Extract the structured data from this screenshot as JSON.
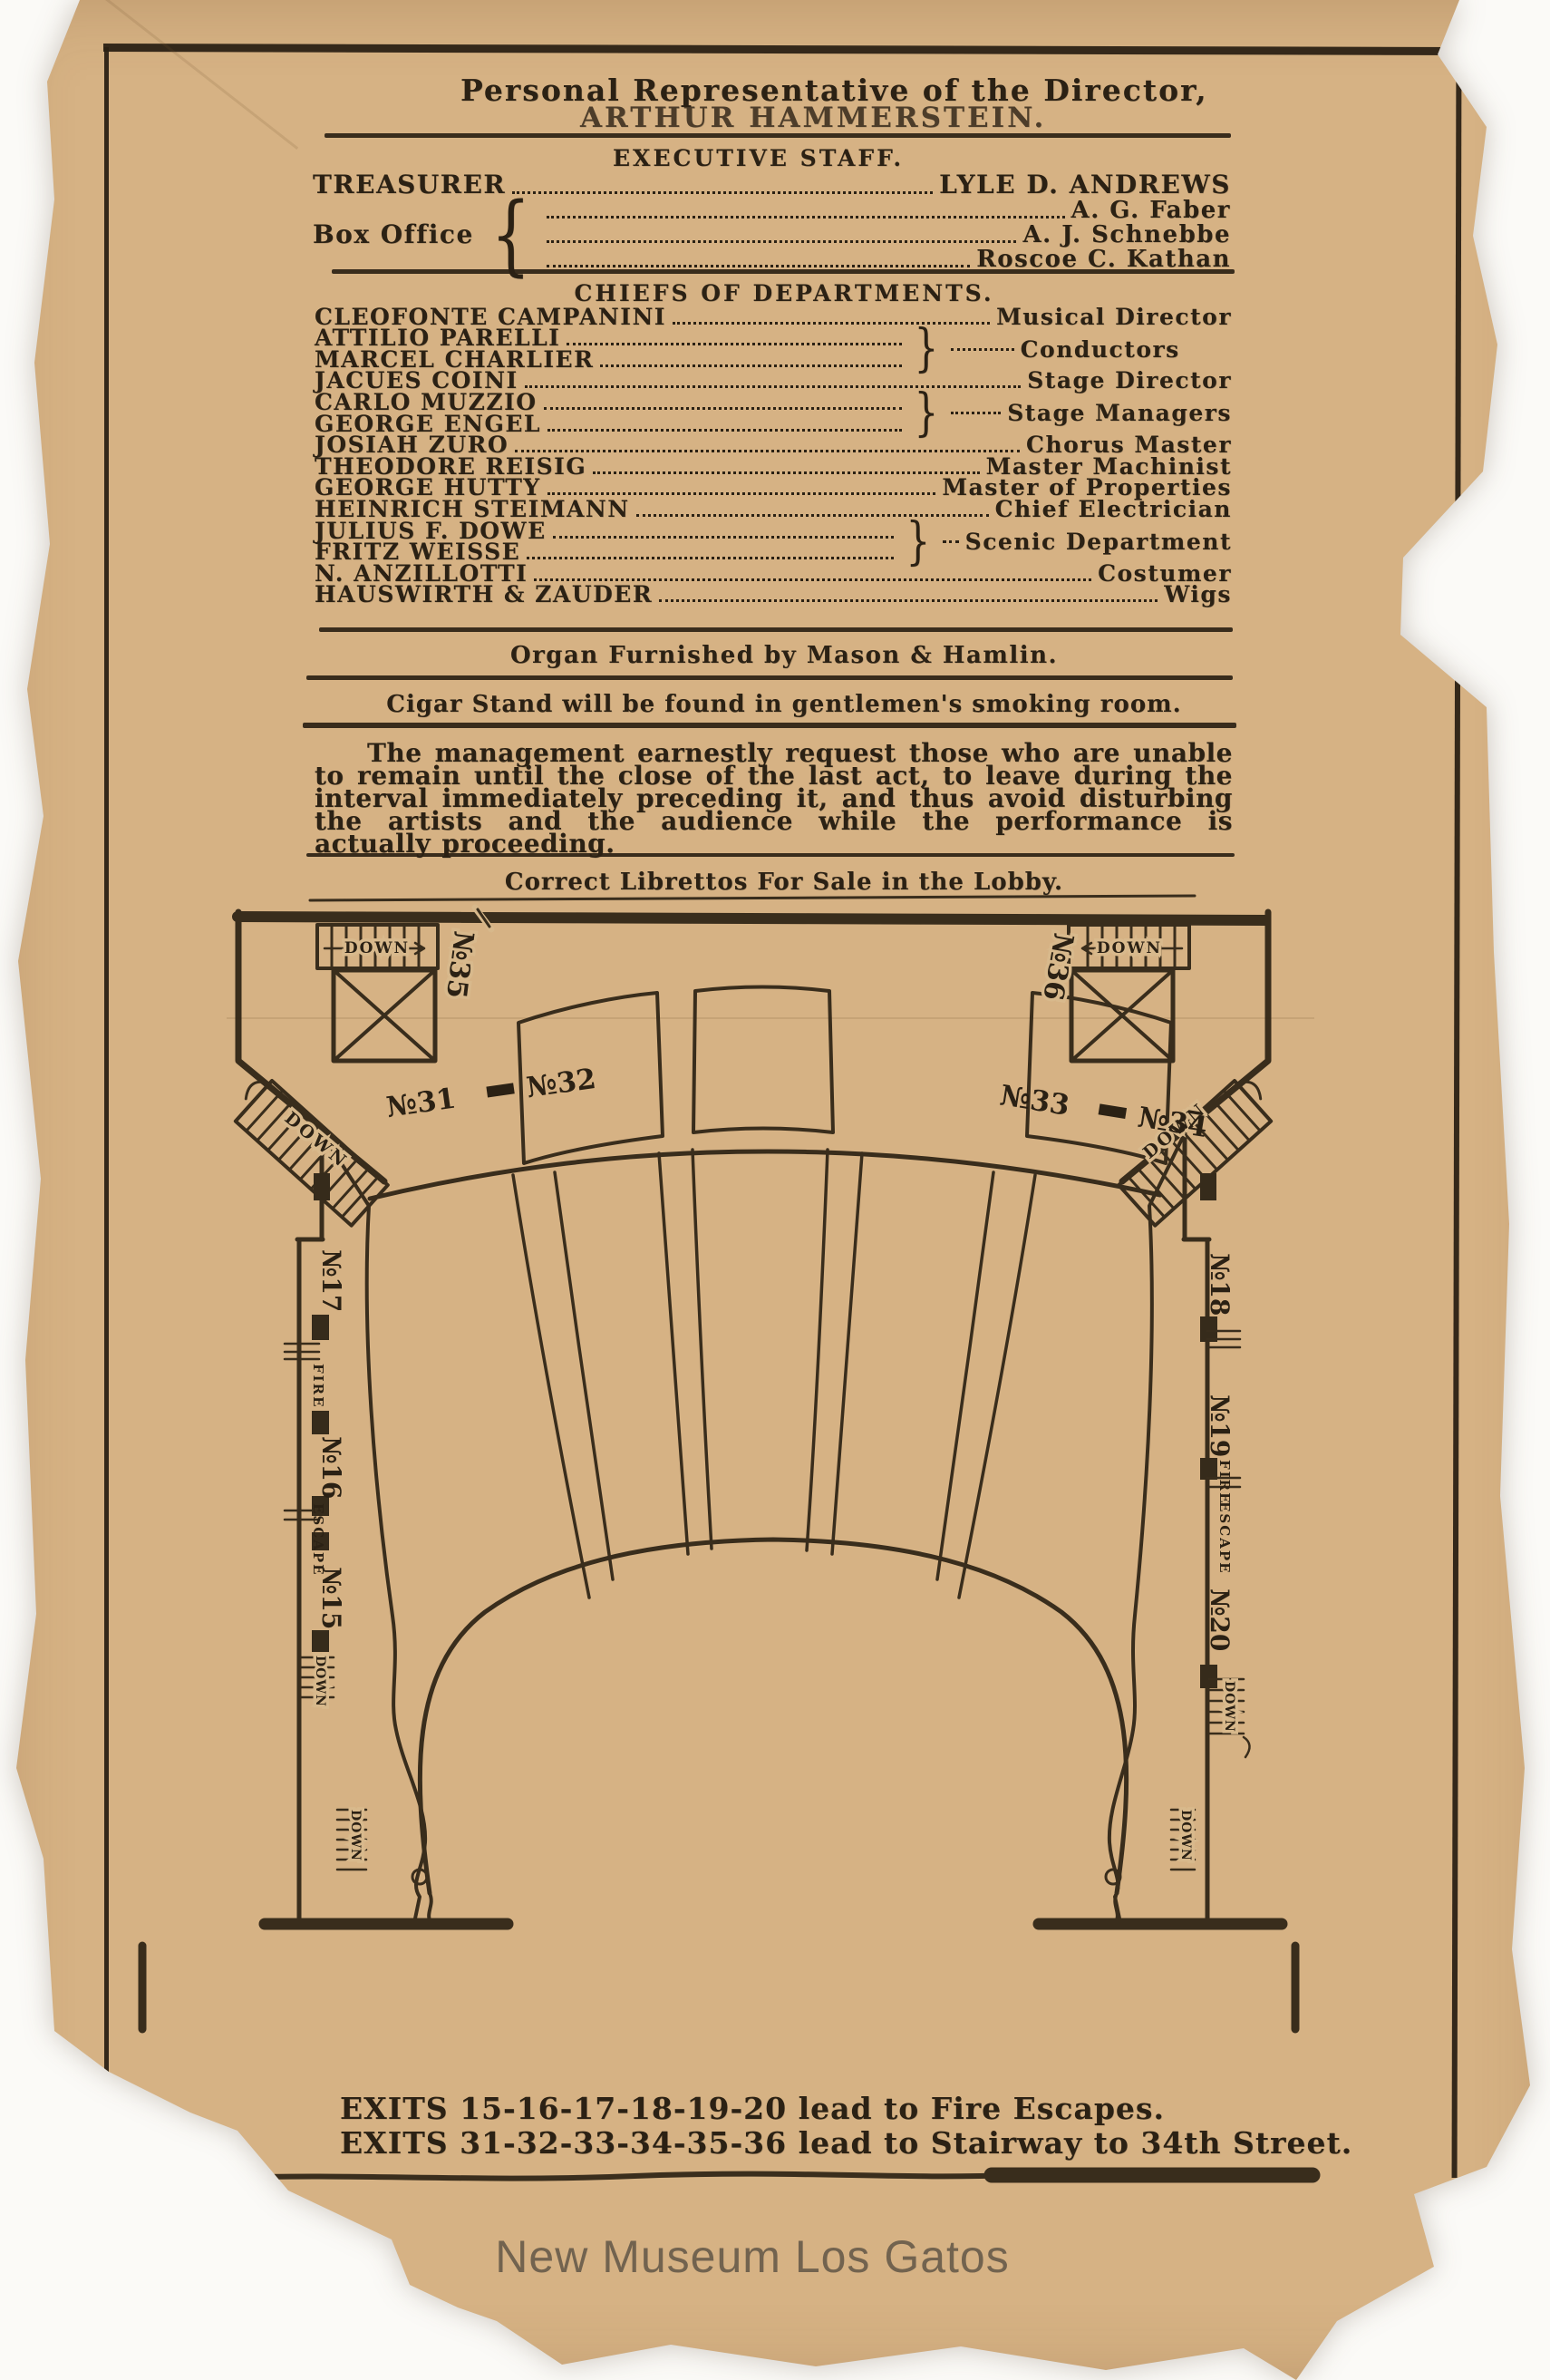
{
  "header": {
    "line1": "Personal Representative of the Director,",
    "line2": "ARTHUR HAMMERSTEIN."
  },
  "executive_staff": {
    "title": "EXECUTIVE STAFF.",
    "treasurer_label": "TREASURER",
    "treasurer_name": "LYLE D. ANDREWS",
    "box_office_label": "Box Office",
    "brace": "{",
    "box_office_names": [
      "A. G. Faber",
      "A. J. Schnebbe",
      "Roscoe C. Kathan"
    ]
  },
  "chiefs": {
    "title": "CHIEFS OF DEPARTMENTS.",
    "brace": "}",
    "rows": [
      {
        "name": "CLEOFONTE CAMPANINI",
        "role": "Musical Director"
      },
      {
        "name1": "ATTILIO PARELLI",
        "name2": "MARCEL CHARLIER",
        "role": "Conductors"
      },
      {
        "name": "JACUES COINI",
        "role": "Stage Director"
      },
      {
        "name1": "CARLO MUZZIO",
        "name2": "GEORGE ENGEL",
        "role": "Stage Managers"
      },
      {
        "name": "JOSIAH ZURO",
        "role": "Chorus Master"
      },
      {
        "name": "THEODORE REISIG",
        "role": "Master Machinist"
      },
      {
        "name": "GEORGE HUTTY",
        "role": "Master of Properties"
      },
      {
        "name": "HEINRICH STEIMANN",
        "role": "Chief Electrician"
      },
      {
        "name1": "JULIUS F. DOWE",
        "name2": "FRITZ WEISSE",
        "role": "Scenic Department"
      },
      {
        "name": "N. ANZILLOTTI",
        "role": "Costumer"
      },
      {
        "name": "HAUSWIRTH & ZAUDER",
        "role": "Wigs"
      }
    ]
  },
  "notices": {
    "organ": "Organ Furnished by Mason & Hamlin.",
    "cigar": "Cigar Stand will be found in gentlemen's smoking room.",
    "management": "The management earnestly request those who are unable to remain until the close of the last act, to leave during the interval immediately preceding it, and thus avoid disturbing the artists and the audience while the performance is actually proceeding.",
    "librettos": "Correct Librettos For Sale in the Lobby."
  },
  "plan": {
    "labels": {
      "down": "DOWN",
      "no35": "№35",
      "no36": "№36",
      "no31": "№31",
      "no32": "№32",
      "no33": "№33",
      "no34": "№34",
      "no17": "№17",
      "no16": "№16",
      "no15": "№15",
      "no18": "№18",
      "no19": "№19",
      "no20": "№20",
      "fire": "FIRE",
      "escape": "ESCAPE"
    }
  },
  "exits": {
    "line1": "EXITS 15-16-17-18-19-20 lead to Fire Escapes.",
    "line2": "EXITS 31-32-33-34-35-36 lead to Stairway to 34th Street."
  },
  "watermark": "New Museum Los Gatos"
}
